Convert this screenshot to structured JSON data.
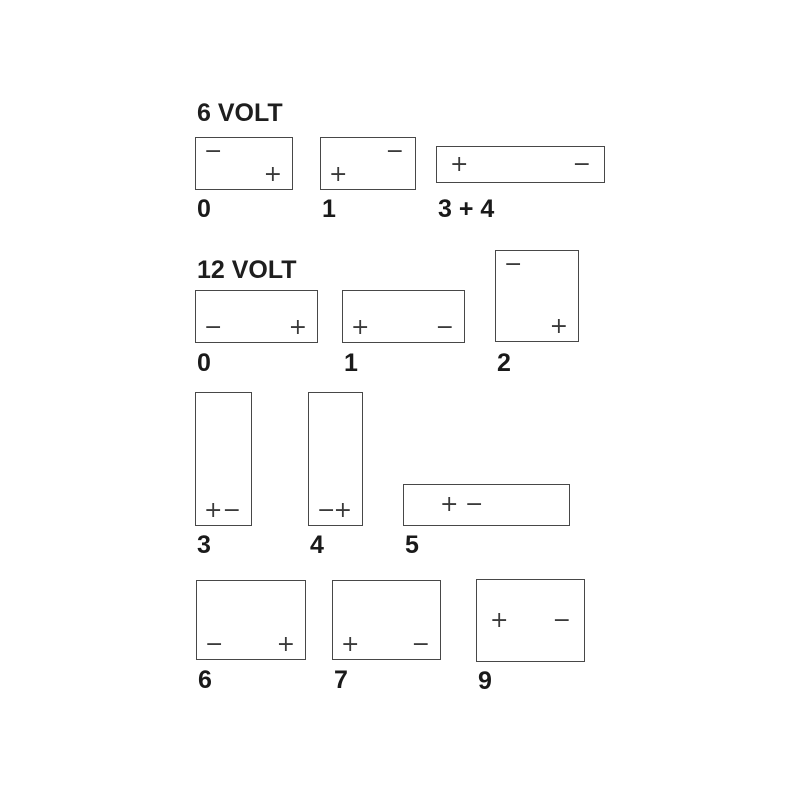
{
  "diagram": {
    "title": "Battery terminal layout codes",
    "background_color": "#ffffff",
    "line_color": "#484848",
    "text_color": "#1a1a1a"
  },
  "sections": [
    {
      "heading": "6 VOLT",
      "batteries": [
        {
          "label": "0",
          "shape": "wide-rectangle",
          "terminals": [
            {
              "sign": "−",
              "position": "top-left"
            },
            {
              "sign": "+",
              "position": "bottom-right"
            }
          ]
        },
        {
          "label": "1",
          "shape": "wide-rectangle",
          "terminals": [
            {
              "sign": "−",
              "position": "top-right"
            },
            {
              "sign": "+",
              "position": "bottom-left"
            }
          ]
        },
        {
          "label": "3 + 4",
          "shape": "long-low-rectangle",
          "terminals": [
            {
              "sign": "+",
              "position": "middle-left"
            },
            {
              "sign": "−",
              "position": "middle-right"
            }
          ]
        }
      ]
    },
    {
      "heading": "12 VOLT",
      "batteries": [
        {
          "label": "0",
          "shape": "wide-rectangle",
          "terminals": [
            {
              "sign": "−",
              "position": "bottom-left"
            },
            {
              "sign": "+",
              "position": "bottom-right"
            }
          ]
        },
        {
          "label": "1",
          "shape": "wide-rectangle",
          "terminals": [
            {
              "sign": "+",
              "position": "bottom-left"
            },
            {
              "sign": "−",
              "position": "bottom-right"
            }
          ]
        },
        {
          "label": "2",
          "shape": "tall-rectangle",
          "terminals": [
            {
              "sign": "−",
              "position": "top-left"
            },
            {
              "sign": "+",
              "position": "bottom-right"
            }
          ]
        },
        {
          "label": "3",
          "shape": "narrow-vertical",
          "terminals": [
            {
              "sign": "+",
              "position": "bottom-left"
            },
            {
              "sign": "−",
              "position": "bottom-right"
            }
          ]
        },
        {
          "label": "4",
          "shape": "narrow-vertical",
          "terminals": [
            {
              "sign": "−",
              "position": "bottom-left"
            },
            {
              "sign": "+",
              "position": "bottom-right"
            }
          ]
        },
        {
          "label": "5",
          "shape": "long-low-rectangle",
          "terminals": [
            {
              "sign": "+",
              "position": "middle-left-inner"
            },
            {
              "sign": "−",
              "position": "middle-left-outer"
            }
          ]
        },
        {
          "label": "6",
          "shape": "large-rectangle",
          "terminals": [
            {
              "sign": "−",
              "position": "bottom-left"
            },
            {
              "sign": "+",
              "position": "bottom-right"
            }
          ]
        },
        {
          "label": "7",
          "shape": "large-rectangle",
          "terminals": [
            {
              "sign": "+",
              "position": "bottom-left"
            },
            {
              "sign": "−",
              "position": "bottom-right"
            }
          ]
        },
        {
          "label": "9",
          "shape": "large-rectangle",
          "terminals": [
            {
              "sign": "+",
              "position": "middle-left"
            },
            {
              "sign": "−",
              "position": "middle-right"
            }
          ]
        }
      ]
    }
  ]
}
